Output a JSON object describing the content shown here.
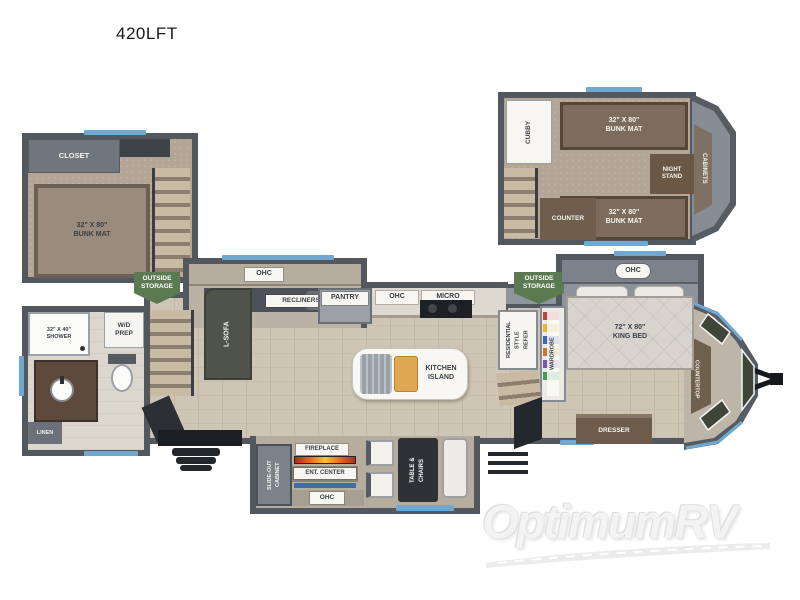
{
  "title": "420LFT",
  "watermark": {
    "brand": "OptimumRV"
  },
  "colors": {
    "accent_blue": "#6fa8d0",
    "wall_gray": "#53585f",
    "storage_green": "#5c7a52",
    "fireplace_orange": "#e86a1e"
  },
  "loft_left": {
    "closet": "CLOSET",
    "bunk_mat": "32\" X 80\"\nBUNK MAT"
  },
  "loft_right": {
    "cubby": "CUBBY",
    "bunk_mat_top": "32\" X 80\"\nBUNK MAT",
    "night_stand": "NIGHT\nSTAND",
    "cabinets": "CABINETS",
    "counter": "COUNTER",
    "bunk_mat_bottom": "32\" X 80\"\nBUNK MAT"
  },
  "bathroom": {
    "shower": "32\" X 40\"\nSHOWER",
    "wd_prep": "W/D\nPREP",
    "linen": "LINEN"
  },
  "living": {
    "outside_storage": "OUTSIDE\nSTORAGE",
    "ohc": "OHC",
    "recliners": "RECLINERS",
    "l_sofa": "L-SOFA"
  },
  "kitchen": {
    "pantry": "PANTRY",
    "ohc": "OHC",
    "micro": "MICRO",
    "island": "KITCHEN\nISLAND",
    "refer": "RESIDENTIAL\nSTYLE\nREFER"
  },
  "bedroom": {
    "outside_storage": "OUTSIDE\nSTORAGE",
    "ohc": "OHC",
    "wardrobe": "WARDROBE",
    "king_bed": "72\" X 80\"\nKING BED",
    "dresser": "DRESSER",
    "countertop": "COUNTERTOP"
  },
  "rear_slide": {
    "cabinet": "SLIDE-OUT\nCABINET",
    "fireplace": "FIREPLACE",
    "ent_center": "ENT. CENTER",
    "ohc": "OHC",
    "table_chairs": "TABLE &\nCHAIRS"
  }
}
